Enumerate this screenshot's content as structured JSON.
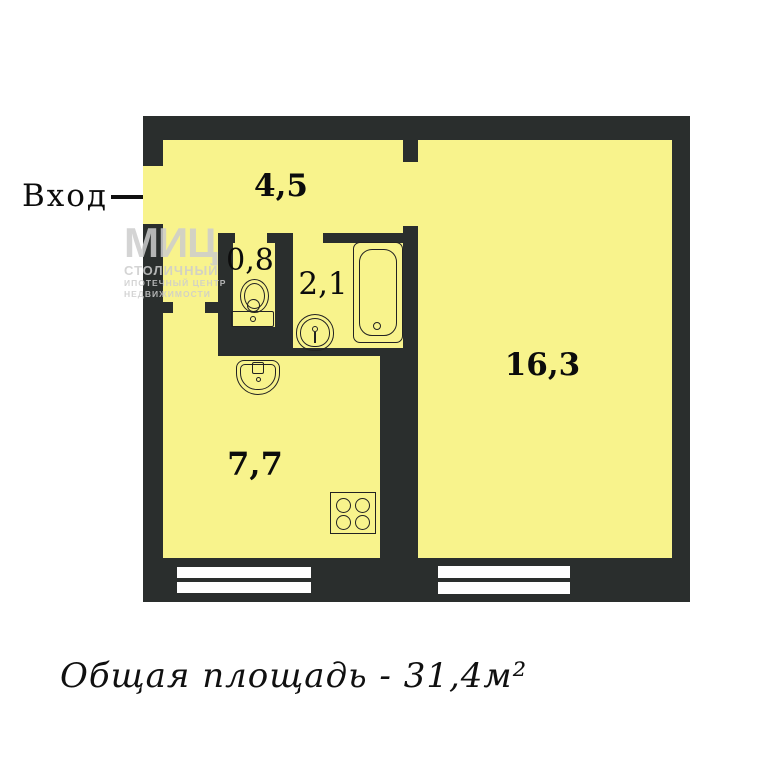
{
  "entrance": {
    "label": "Вход"
  },
  "rooms": {
    "hallway": {
      "area": "4,5"
    },
    "toilet": {
      "area": "0,8"
    },
    "bathroom": {
      "area": "2,1"
    },
    "living": {
      "area": "16,3"
    },
    "kitchen": {
      "area": "7,7"
    }
  },
  "caption": {
    "text": "Общая площадь - 31,4м²"
  },
  "watermark": {
    "brand": "МИЦ",
    "line1": "СТОЛИЧНЫЙ",
    "line2": "ИПОТЕЧНЫЙ ЦЕНТР",
    "line3": "НЕДВИЖИМОСТИ"
  },
  "colors": {
    "floor": "#f8f38c",
    "wall": "#2a2e2d",
    "window": "#ffffff",
    "text": "#0c0c0c"
  }
}
